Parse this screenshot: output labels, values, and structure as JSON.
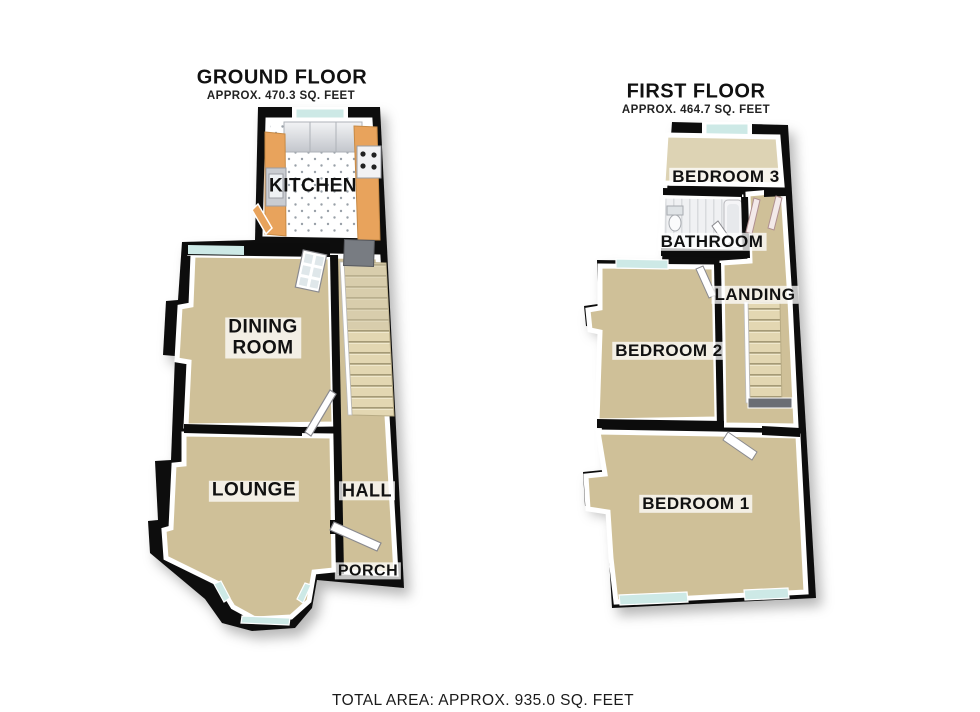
{
  "ground_floor": {
    "title": "GROUND FLOOR",
    "area_text": "APPROX. 470.3 SQ. FEET",
    "rooms": {
      "kitchen": "KITCHEN",
      "dining_room": "DINING\nROOM",
      "lounge": "LOUNGE",
      "hall": "HALL",
      "porch": "PORCH"
    }
  },
  "first_floor": {
    "title": "FIRST FLOOR",
    "area_text": "APPROX. 464.7 SQ. FEET",
    "rooms": {
      "bedroom3": "BEDROOM 3",
      "bathroom": "BATHROOM",
      "landing": "LANDING",
      "bedroom2": "BEDROOM 2",
      "bedroom1": "BEDROOM 1"
    }
  },
  "footer": {
    "total_area": "TOTAL AREA: APPROX. 935.0 SQ. FEET"
  },
  "colors": {
    "page-bg": "#ffffff",
    "wall": "#0c0c0c",
    "carpet": "#cfc098",
    "carpet-light": "#ddd3b4",
    "window": "#cde9e6",
    "counter": "#e8a35c",
    "cabinet": "#d4d6da",
    "stairs": "#e3d7b2",
    "stair-line": "#a59a76",
    "lino": "#f0f1f3",
    "label-bg": "rgba(255,255,255,0.75)",
    "text": "#111111"
  }
}
